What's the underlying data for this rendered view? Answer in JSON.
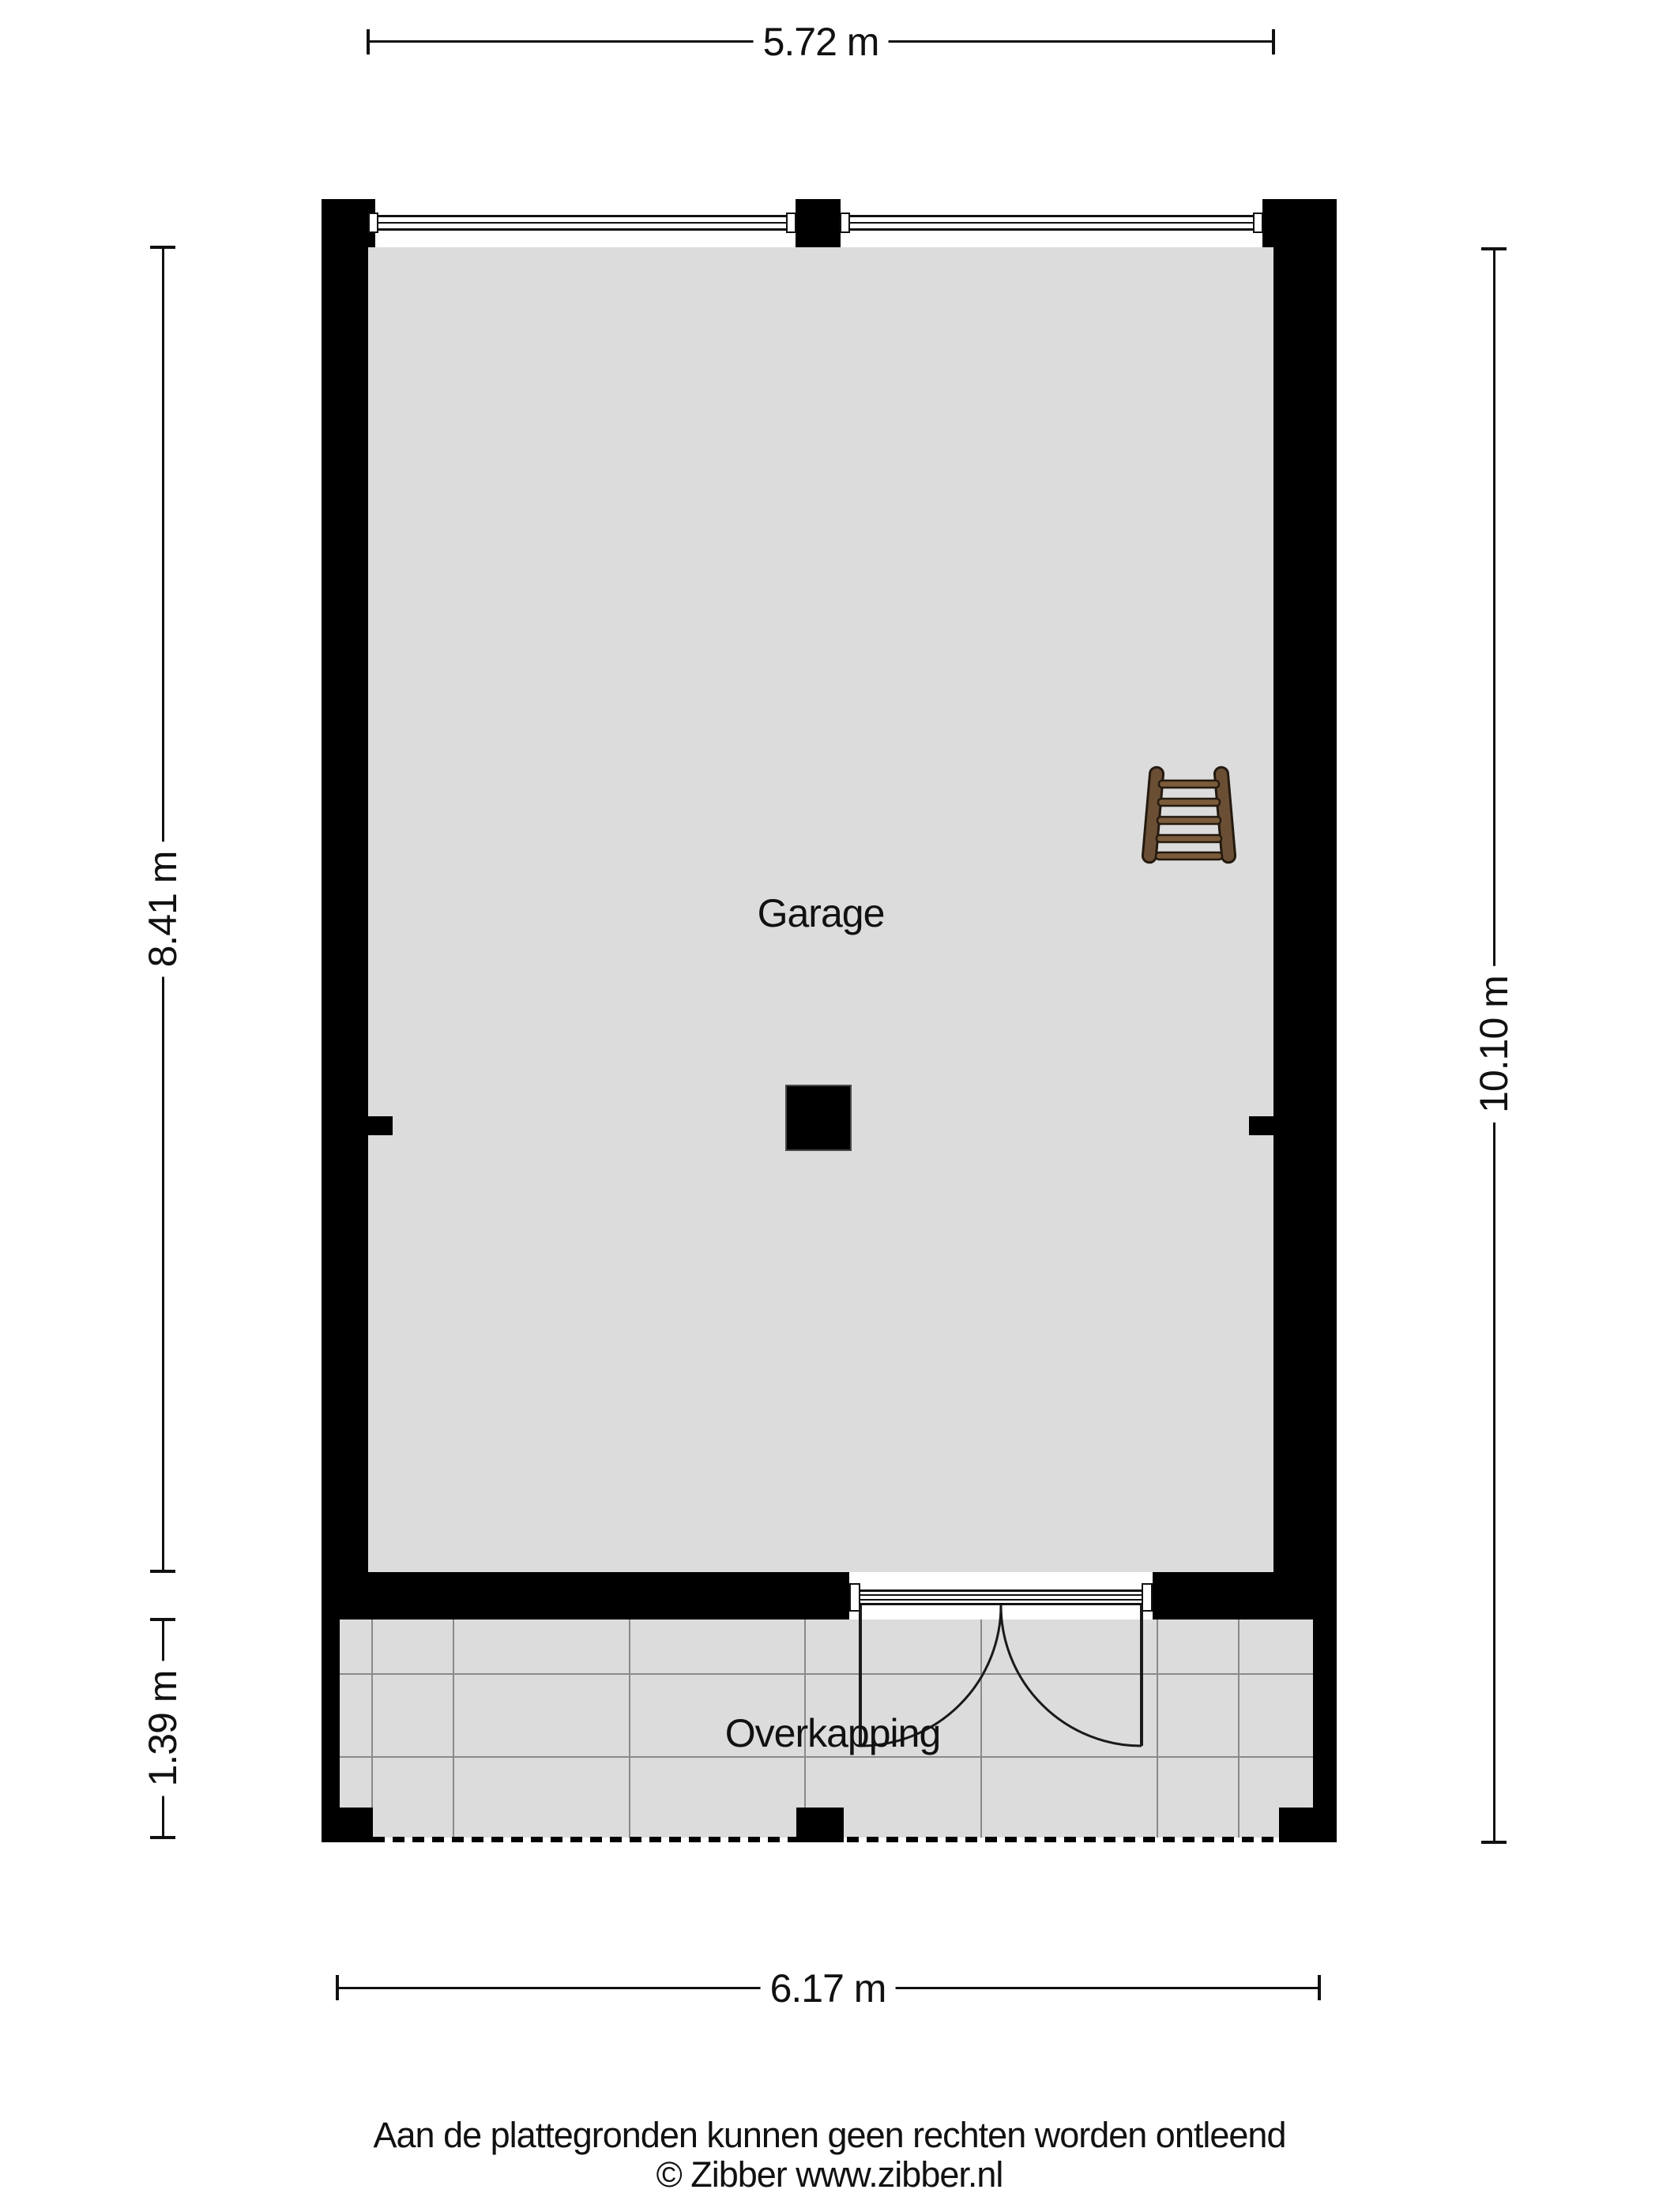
{
  "plan": {
    "type": "floor-plan",
    "rooms": {
      "garage": {
        "label": "Garage"
      },
      "overkapping": {
        "label": "Overkapping"
      }
    },
    "dimensions": {
      "top": {
        "label": "5.72 m"
      },
      "left_upper": {
        "label": "8.41 m"
      },
      "left_lower": {
        "label": "1.39 m"
      },
      "right": {
        "label": "10.10 m"
      },
      "bottom": {
        "label": "6.17 m"
      }
    },
    "icons": {
      "ladder": "ladder-icon"
    },
    "colors": {
      "wall": "#000000",
      "floor": "#dcdcdc",
      "tile_line": "#8a8a8a",
      "ladder_wood": "#6a4f35",
      "ladder_rung": "#7b5b3a",
      "ladder_outline": "#241a10"
    }
  },
  "footer": {
    "disclaimer": "Aan de plattegronden kunnen geen rechten worden ontleend",
    "credit": "© Zibber www.zibber.nl"
  }
}
